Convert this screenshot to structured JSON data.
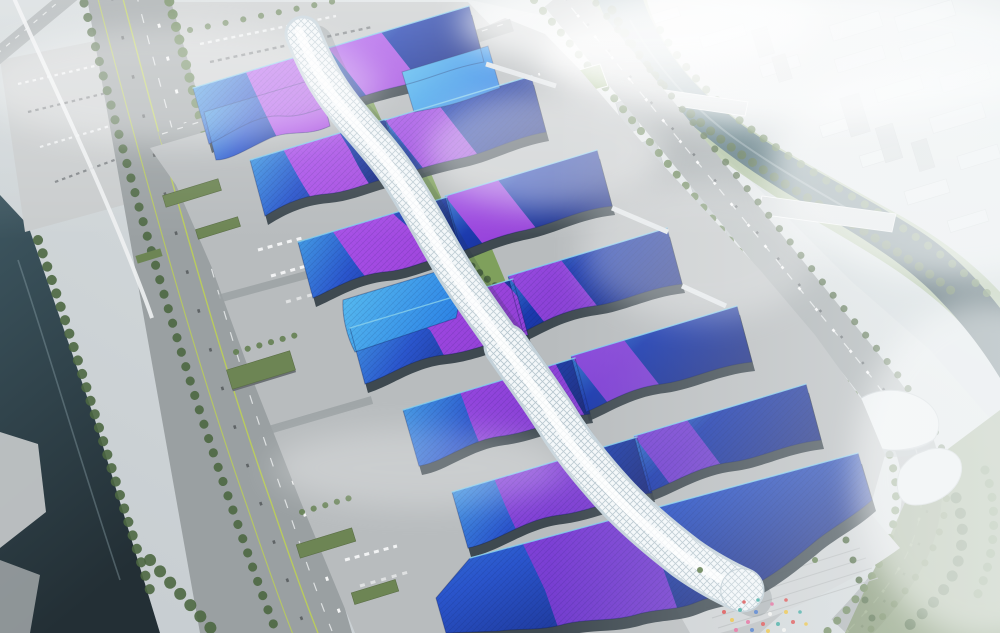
{
  "scene": {
    "type": "aerial architectural rendering",
    "description": "Hazy daylight aerial rendering of a vast exhibition and convention center: seven staggered rows of paired exhibition halls with wave-edged blue roofs, swept by continuous violet ribbon graphics, flank a white diamond-quilted serpentine concourse that snakes from the north entrance to a rounded tip above the south entry plaza with a colorful crowd. A tree-lined expressway and dark canal border the west side with parking lots to the north; a teal river with two road bridges, a boulevard, gray mid-rise towers, curved white cultural buildings, a curving boulevard and a foggy white high-rise district fill the east side.",
    "time_of_day": "hazy daylight",
    "landmarks": [
      {
        "name": "central-concourse-spine",
        "label": "Serpentine white concourse with diamond-quilted roof"
      },
      {
        "name": "exhibition-halls",
        "label": "Paired exhibition halls with blue wave roofs and violet ribbon graphics",
        "count": 13
      },
      {
        "name": "grand-south-hall",
        "label": "Largest southern hall with scalloped roof edge"
      },
      {
        "name": "green-courtyards",
        "label": "Planted courtyards beside the concourse"
      },
      {
        "name": "west-expressway",
        "label": "Tree-lined expressway and canal on the west side"
      },
      {
        "name": "north-parking",
        "label": "Surface parking lots with rows of cars"
      },
      {
        "name": "east-river",
        "label": "Teal river crossed by two road bridges"
      },
      {
        "name": "city-skyline",
        "label": "Hazy white high-rise district"
      },
      {
        "name": "curved-boulevard",
        "label": "Curving boulevard at the south-east corner"
      },
      {
        "name": "entry-plaza",
        "label": "Stepped south plaza with colorful crowd and palms"
      }
    ]
  },
  "colors": {
    "haze_white": "#f2f5f6",
    "haze_gray": "#c6ccd0",
    "city_base": "#d5dbde",
    "city_block": "#e3e8ea",
    "city_tower": "#b9c0c3",
    "water_dark": "#2f474f",
    "water_mid": "#47666f",
    "water_light": "#6a8b95",
    "canal_dark": "#232f35",
    "canal_mid": "#3d5660",
    "road_dark": "#85898c",
    "road_mid": "#9aa0a2",
    "road_light": "#aab0b2",
    "ground": "#b8bcbe",
    "ground_light": "#c9cccd",
    "lane_lime": "#bccf55",
    "tree_dark": "#4d6741",
    "tree_mid": "#5f7c4c",
    "lawn": "#7fa05c",
    "roofgarden": "#6d8554",
    "roof_cyan": "#4cb2ec",
    "roof_azure": "#2f86e6",
    "roof_blue": "#2a55cc",
    "roof_indigo": "#1b3aae",
    "roof_deep": "#17287e",
    "ribbon_magenta": "#c05cf0",
    "ribbon_violet": "#a845e2",
    "ribbon_purple": "#7a3cd2",
    "spine_white": "#f3f7f9",
    "spine_shade": "#c3d1d9",
    "spine_shadow": "#24313a",
    "glass_dark": "#333f47",
    "fascia": "#eef2f4",
    "bridge": "#d3d8da",
    "crowd_red": "#d94f4f",
    "crowd_pink": "#e06a9a",
    "crowd_yellow": "#e8c044",
    "crowd_teal": "#3fa8a0",
    "crowd_blue": "#4878c8",
    "crowd_white": "#f0f0ee"
  }
}
